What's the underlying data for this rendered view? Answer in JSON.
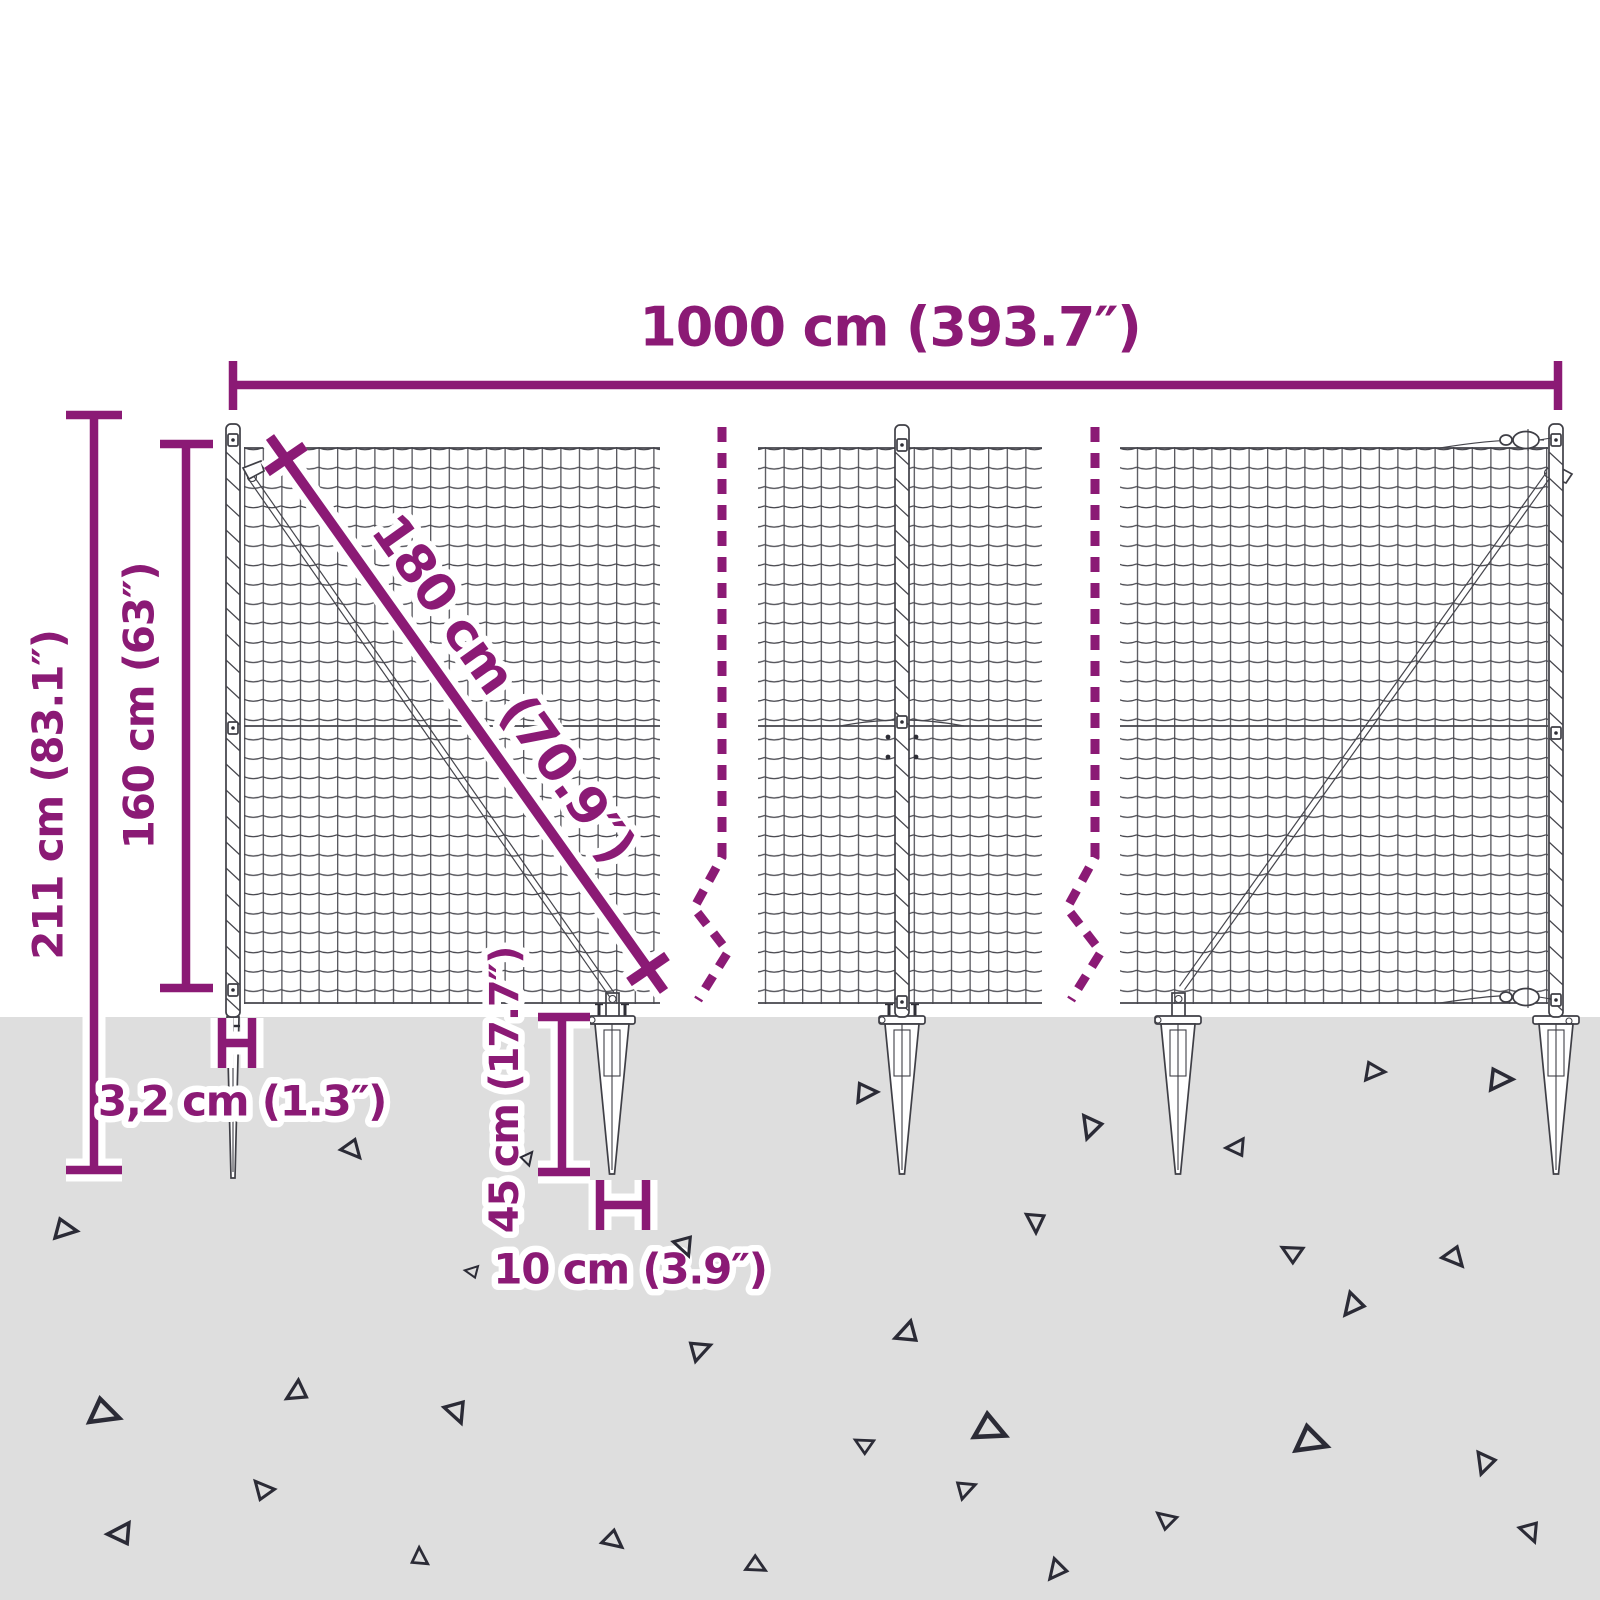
{
  "dimensions": {
    "total_width": "1000 cm (393.7″)",
    "total_height": "211 cm (83.1″)",
    "fence_height": "160 cm (63″)",
    "brace_length": "180 cm (70.9″)",
    "spike_width_small": "3,2 cm (1.3″)",
    "anchor_depth": "45 cm (17.7″)",
    "anchor_width": "10 cm (3.9″)"
  },
  "colors": {
    "accent_purple": "#8b1a75",
    "ground_gray": "#dedede",
    "fence_line": "#45454c",
    "debris_outline": "#2b2b36",
    "background": "#ffffff"
  }
}
